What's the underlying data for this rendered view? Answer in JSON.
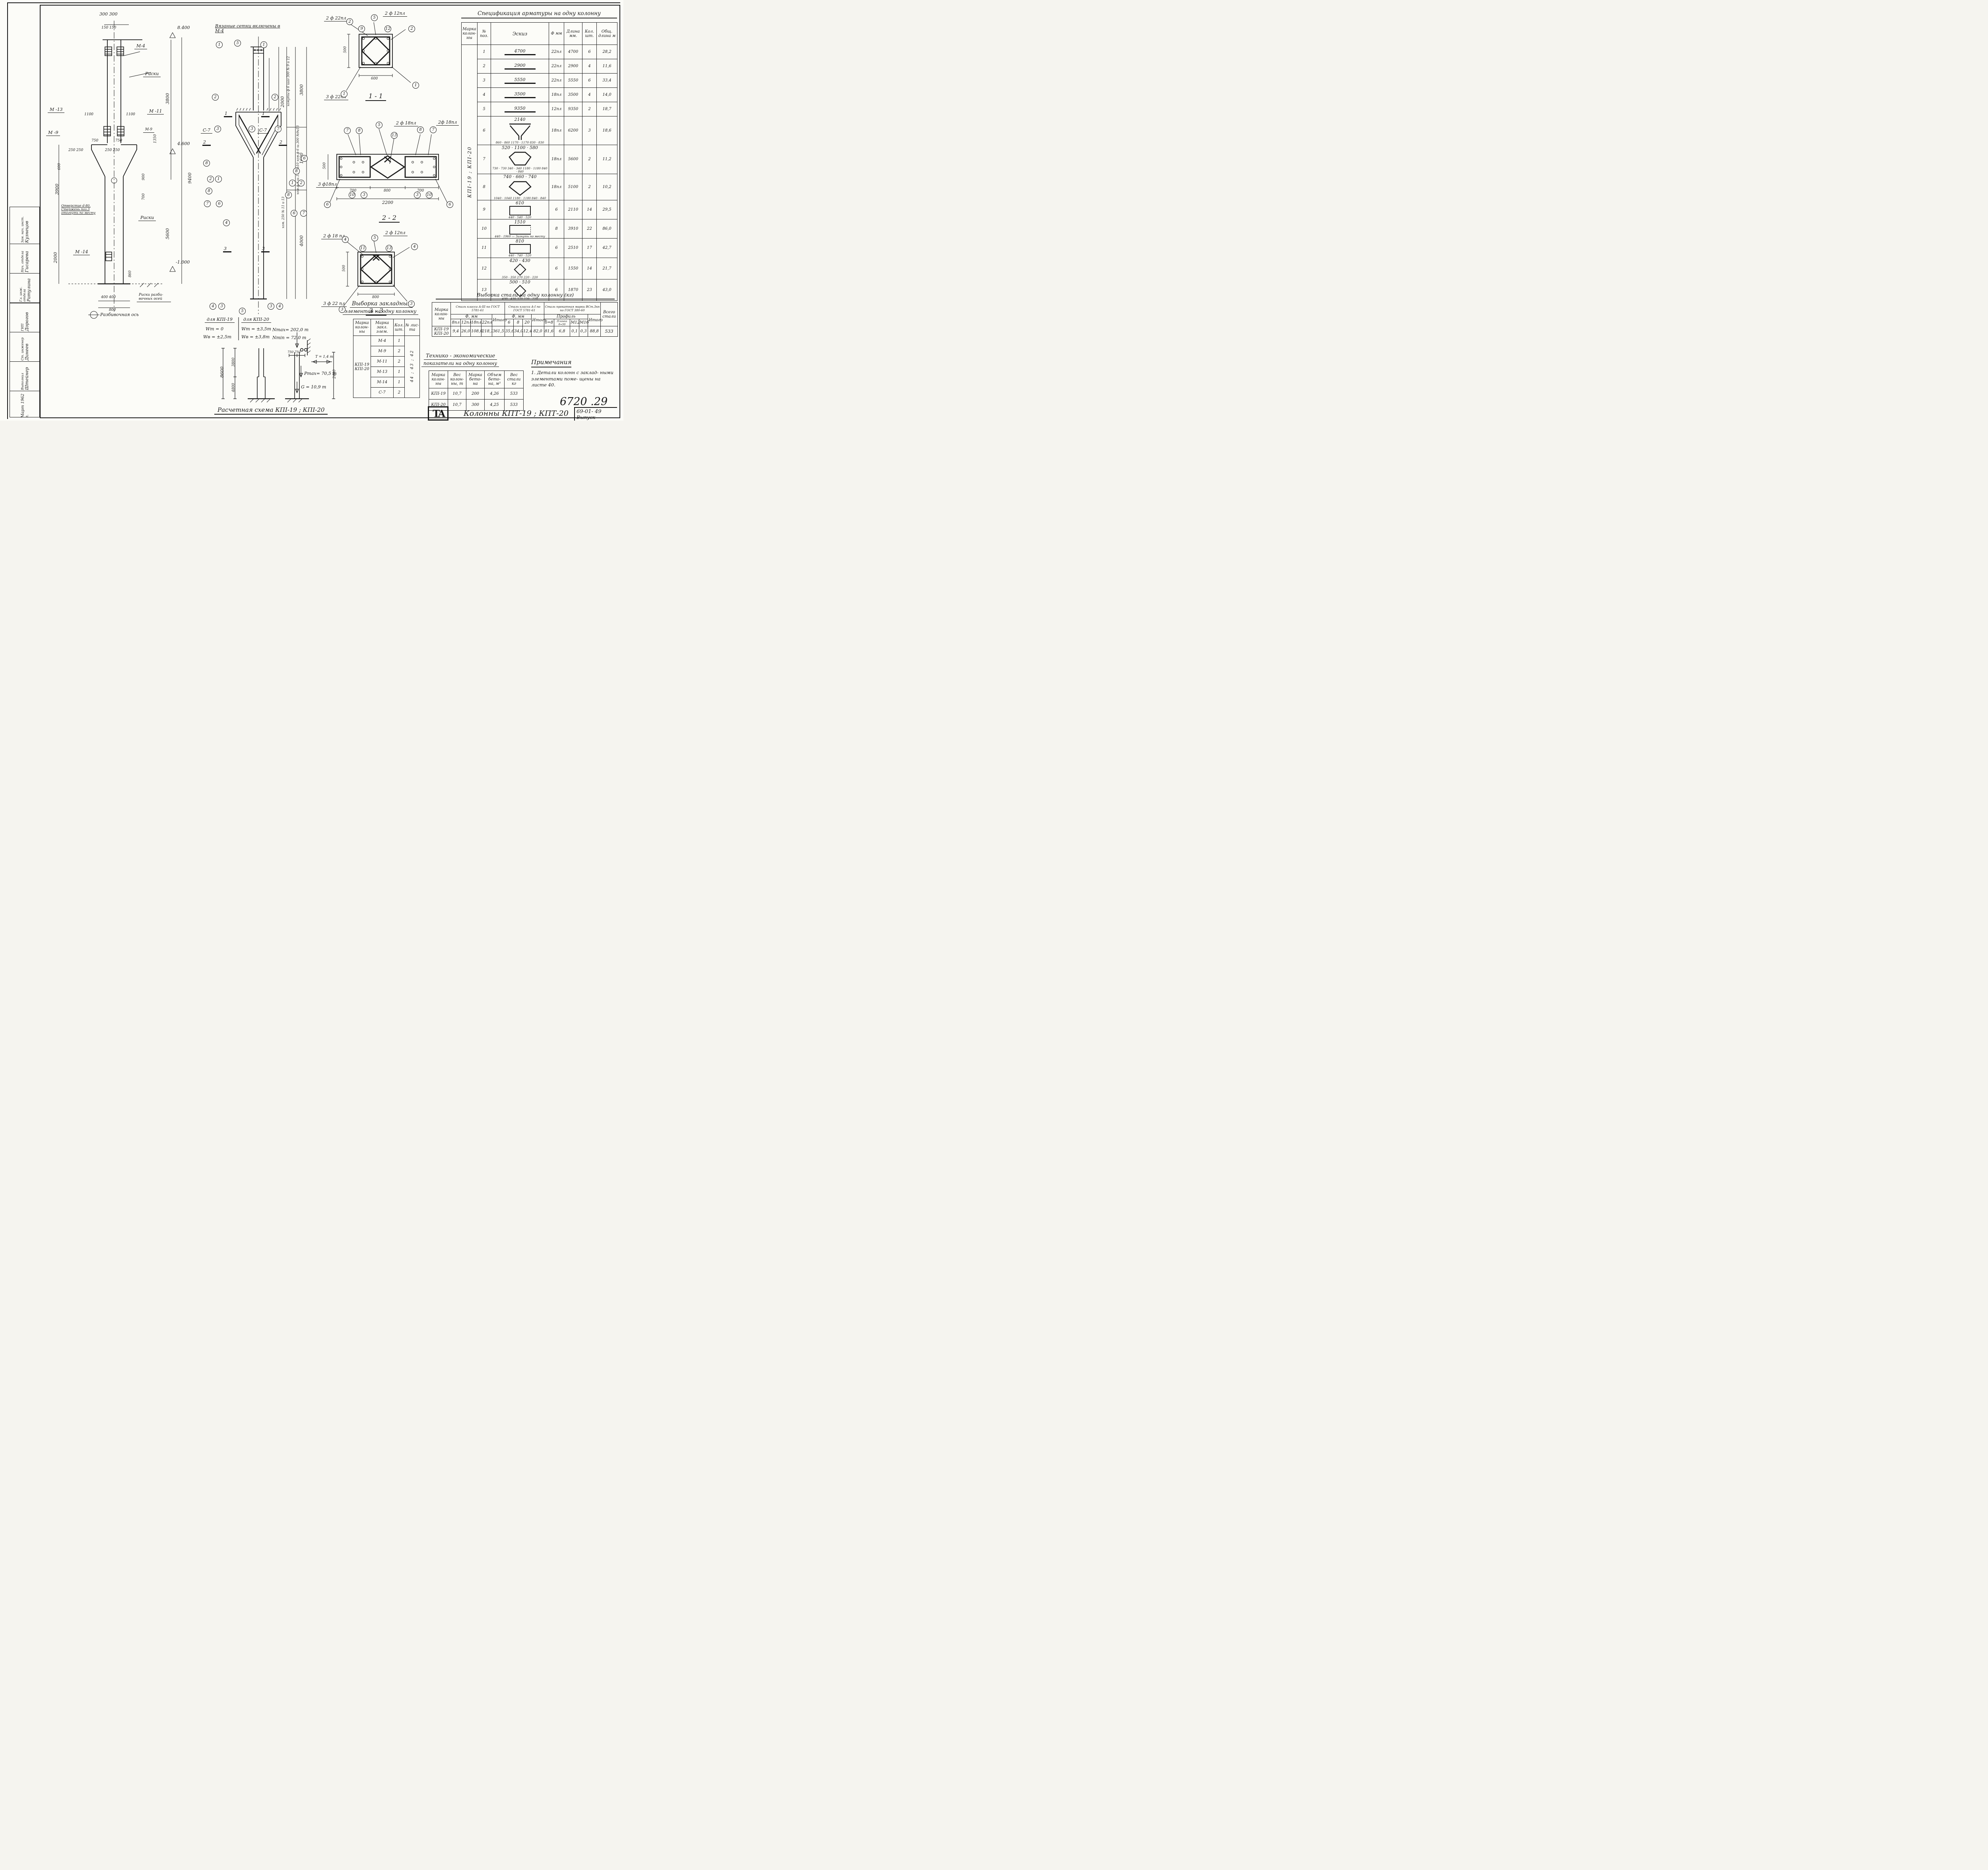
{
  "doc": {
    "number": "6720 .29",
    "project_code": "69-01- 49",
    "project_code2": "Выпуск",
    "logo": "ТА",
    "bottom_title": "Колонны КПТ-19 ; КПТ-20"
  },
  "spec": {
    "title": "Спецификация арматуры на одну колонну",
    "headers": {
      "mark": "Марка колон- ны",
      "pos": "№ поз.",
      "esk": "Эскиз",
      "dia": "Ф мм",
      "len": "Длина мм.",
      "qty": "Кол. шт.",
      "total": "Общ. длина м"
    },
    "mark": "КПІ-19 ; КПІ-20",
    "rows": [
      {
        "pos": "1",
        "esk": "4700",
        "note": "",
        "dia": "22пл",
        "len": "4700",
        "qty": "6",
        "total": "28,2"
      },
      {
        "pos": "2",
        "esk": "2900",
        "note": "",
        "dia": "22пл",
        "len": "2900",
        "qty": "4",
        "total": "11,6"
      },
      {
        "pos": "3",
        "esk": "5550",
        "note": "",
        "dia": "22пл",
        "len": "5550",
        "qty": "6",
        "total": "33,4"
      },
      {
        "pos": "4",
        "esk": "3500",
        "note": "",
        "dia": "18пл",
        "len": "3500",
        "qty": "4",
        "total": "14,0"
      },
      {
        "pos": "5",
        "esk": "9350",
        "note": "",
        "dia": "12пл",
        "len": "9350",
        "qty": "2",
        "total": "18,7"
      },
      {
        "pos": "6",
        "esk": "2140",
        "note": "860 · 860   1170 · 1170   830 · 830",
        "dia": "18пл",
        "len": "6200",
        "qty": "3",
        "total": "18,6"
      },
      {
        "pos": "7",
        "esk": "520 · 1100 · 580",
        "note": "730 · 730   340 · 340   1180 · 1180   840 · 840",
        "dia": "18пл",
        "len": "5600",
        "qty": "2",
        "total": "11,2"
      },
      {
        "pos": "8",
        "esk": "740 · 660 · 740",
        "note": "1040 · 1040   1180 · 1180   840 · 840",
        "dia": "18пл",
        "len": "5100",
        "qty": "2",
        "total": "10,2"
      },
      {
        "pos": "9",
        "esk": "610",
        "note": "440 · 540 · 520",
        "dia": "6",
        "len": "2110",
        "qty": "14",
        "total": "29,5"
      },
      {
        "pos": "10",
        "esk": "1510",
        "note": "440 · 1960 — Загнуть по месту",
        "dia": "8",
        "len": "3910",
        "qty": "22",
        "total": "86,0"
      },
      {
        "pos": "11",
        "esk": "810",
        "note": "440 · 740 · 520",
        "dia": "6",
        "len": "2510",
        "qty": "17",
        "total": "42,7"
      },
      {
        "pos": "12",
        "esk": "420 · 430",
        "note": "350 · 350   270   220 · 220",
        "dia": "6",
        "len": "1550",
        "qty": "14",
        "total": "21,7"
      },
      {
        "pos": "13",
        "esk": "500 · 510",
        "note": "430 · 430   370   220 · 220",
        "dia": "6",
        "len": "1870",
        "qty": "23",
        "total": "43,0"
      }
    ]
  },
  "steel": {
    "title": "Выборка стали на одну колонну (кг)",
    "mark_header": "Марка колон- ны",
    "mark": "КПI-19 КПI-20",
    "g1": {
      "title": "Сталь класса А-III по ГОСТ 5781-61",
      "sub": "Ф, мм",
      "c1": "8пл",
      "c2": "12пл",
      "c3": "18пл",
      "c4": "22пл",
      "itogo_label": "Итого",
      "v1": "9,4",
      "v2": "26,0",
      "v3": "108,0",
      "v4": "218,1",
      "itogo": "361,5"
    },
    "g2": {
      "title": "Сталь класса А-I по ГОСТ 5781-61",
      "sub": "Ф, мм",
      "c1": "6",
      "c2": "8",
      "c3": "20",
      "itogo_label": "Итого",
      "v1": "35,6",
      "v2": "34,0",
      "v3": "12,4",
      "itogo": "82,0"
    },
    "g3": {
      "title": "Сталь прокатная марки ВСт.3кп по ГОСТ 380-60",
      "sub": "Профиль",
      "c1": "δ=8",
      "c2": "Планка δ=50",
      "c3": "М12",
      "c4": "М16",
      "itogo_label": "Итого",
      "v1": "81,6",
      "v2": "6,8",
      "v3": "0,1",
      "v4": "0,3",
      "itogo": "88,8"
    },
    "total_header": "Всего стали",
    "total": "533"
  },
  "tep": {
    "title1": "Технико - экономические",
    "title2": "показатели на одну колонну",
    "h_mark": "Марка колон- ны",
    "h_weight": "Вес колон- ны, т",
    "h_grade": "Марка бето- на",
    "h_volume": "Объем бето- на, м³",
    "h_steel": "Вес стали кг",
    "r1": {
      "mark": "КПI-19",
      "weight": "10,7",
      "grade": "200",
      "volume": "4,26",
      "steel": "533"
    },
    "r2": {
      "mark": "КПI-20",
      "weight": "10,7",
      "grade": "300",
      "volume": "4,25",
      "steel": "533"
    }
  },
  "embed": {
    "title1": "Выборка закладных",
    "title2": "элементов на одну колонну",
    "h_mark": "Марка колон- ны",
    "h_elem": "Марка закл. элем.",
    "h_qty": "Кол. шт.",
    "h_sheet": "№ лис- та",
    "mark": "КПІ-19 КПІ-20",
    "sheets": "44 ; 43 ; 42",
    "rows": [
      {
        "elem": "М-4",
        "qty": "1"
      },
      {
        "elem": "М-9",
        "qty": "2"
      },
      {
        "elem": "М-11",
        "qty": "2"
      },
      {
        "elem": "М-13",
        "qty": "1"
      },
      {
        "elem": "М-14",
        "qty": "1"
      },
      {
        "elem": "С-7",
        "qty": "2"
      }
    ]
  },
  "notes": {
    "title": "Примечания",
    "item1": "1. Детали колонн с заклад- ными элементами поме- щены на листе 40."
  },
  "calc": {
    "caption": "Расчетная схема КПІ-19 ; КПІ-20",
    "head1": "для КПІ-19",
    "head2": "для КПІ-20",
    "w1a": "Wт = 0",
    "w1b": "Wв = ±2,5т",
    "w2a": "Wт = ±3,5т",
    "w2b": "Wв = ±3,8т",
    "nmax": "Nmax= 202,0 т",
    "nmin": "Nmin = 72,0 т",
    "t": "T = 1,4 т",
    "pmax": "Pmax= 70,5 т",
    "g": "G = 10,9 т",
    "dim_8600": "8600",
    "dim_3800": "3800",
    "dim_4800": "4800",
    "dim_750": "750  750",
    "dim_2400": "2400"
  },
  "left_view": {
    "dim_300": "300  300",
    "dim_150": "150 150",
    "m4": "М-4",
    "riski": "Риски",
    "riski2": "Риски",
    "elev_8400": "8.400",
    "dim_3800": "3800",
    "m13": "М -13",
    "dim_1100a": "1100",
    "dim_1100b": "1100",
    "m11": "М -11",
    "m9": "М -9",
    "m9b": "М-9",
    "dim_1350": "1350",
    "dim_350": "350",
    "dim_750": "750",
    "dim_750b": "750",
    "dim_250a": "250 250",
    "dim_250b": "250 250",
    "elev_4600": "4.600",
    "dim_600": "600",
    "dim_900": "900",
    "dim_700": "700",
    "dim_9400": "9400",
    "dim_3900": "3900",
    "hole_note": "Отверстие d-80. Стержень поз.3 отогнуть по месту",
    "dim_5600": "5600",
    "dim_2000": "2000",
    "m14": "М -14",
    "dim_860": "860",
    "dim_400": "400   400",
    "dim_800": "800",
    "elev_m1000": "-1.000",
    "axis_note": "Риски разби- вочных осей",
    "axis": "Разбивочная ось"
  },
  "mid_view": {
    "top_note": "Вязаные сетки включены в М-4",
    "s7": "С-7",
    "homut1": "хомуты ф 6 шаг 300  № 9 и 12",
    "homut2": "хом.ф 8 ш.150 №10   хом.ф 6 ш.300 №9и13",
    "homut3": "хом. 250  № 11 и 13",
    "dim_2000": "2000",
    "dim_3800": "3800",
    "dim_1600": "1600",
    "dim_4000": "4000",
    "mark1": "1",
    "mark2": "2",
    "mark3": "3",
    "callouts": [
      "1",
      "5",
      "1",
      "2",
      "2",
      "3",
      "3",
      "7",
      "8",
      "2",
      "1",
      "8",
      "7",
      "6",
      "4",
      "6",
      "8",
      "1",
      "2",
      "8",
      "6",
      "7",
      "4",
      "3",
      "5",
      "3",
      "4"
    ]
  },
  "sec11": {
    "caption": "1 - 1",
    "bar_2f22": "2 ф 22пл",
    "bar_2f12": "2 ф 12пл",
    "bar_3f22": "3 ф 22пл",
    "dim_500": "500",
    "dim_600": "600",
    "callouts": [
      "2",
      "5",
      "9",
      "12",
      "2",
      "1",
      "1"
    ]
  },
  "sec22": {
    "caption": "2 - 2",
    "bar_2f18a": "2 ф 18пл",
    "bar_2f18b": "2ф 18пл",
    "bar_3f18": "3 ф18пл",
    "dim_500": "500",
    "dim_700a": "700",
    "dim_800": "800",
    "dim_700b": "700",
    "dim_2200": "2200",
    "callouts": [
      "7",
      "8",
      "5",
      "13",
      "8",
      "7",
      "10",
      "3",
      "3",
      "10",
      "6",
      "6"
    ]
  },
  "sec33": {
    "caption": "3 - 3",
    "bar_2f18": "2 ф 18 пл",
    "bar_2f12": "2 ф 12пл",
    "bar_3f22": "3 ф 22 пл",
    "dim_500": "500",
    "dim_800": "800",
    "callouts": [
      "4",
      "11",
      "5",
      "13",
      "4",
      "3",
      "3"
    ]
  },
  "stamp": {
    "rows": [
      {
        "role": "Зам. нач. инст.",
        "name": "Кузнецов"
      },
      {
        "role": "Нач. отдела",
        "name": "Гисарева"
      },
      {
        "role": "Гл. инж. отдела",
        "name": "Ратулина"
      },
      {
        "role": "ГИП",
        "name": "Дорогов"
      },
      {
        "role": "Ст. инженер",
        "name": "Динеев"
      },
      {
        "role": "Выполнил",
        "name": "Штейнер"
      }
    ],
    "date": "Март  1962 г."
  }
}
